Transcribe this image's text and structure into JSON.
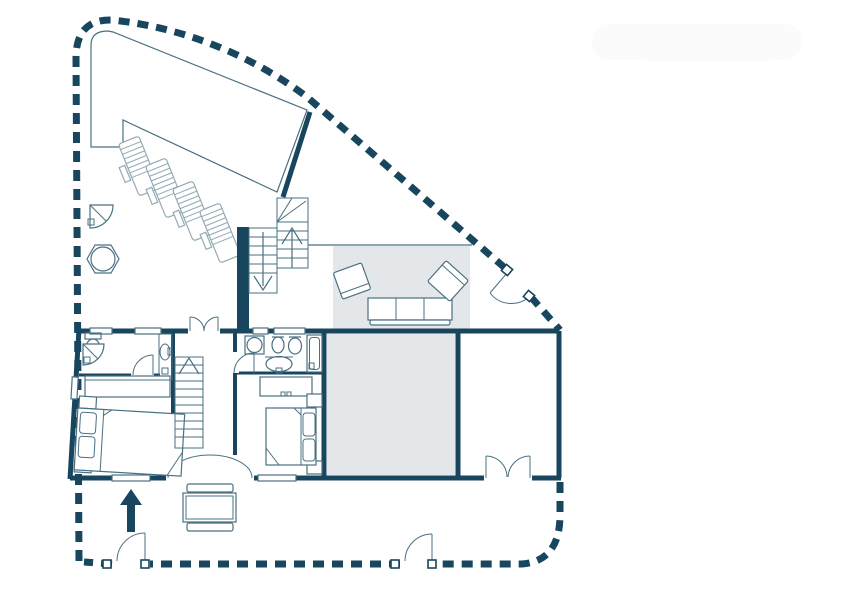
{
  "image": {
    "width": 842,
    "height": 595,
    "background": "#ffffff",
    "type": "architectural-floor-plan",
    "visible_text": []
  },
  "colors": {
    "wall": "#17465e",
    "line": "#4a7082",
    "light": "#93a9b4",
    "shade": "#e4e7e9",
    "watermark": "#fbfbfb"
  },
  "floor_plan": {
    "boundary": "thick dashed property fence with rounded corners, three gate openings with swing doors",
    "areas": [
      {
        "name": "pool-terrace",
        "desc": "large slanted polygon deck, top-left"
      },
      {
        "name": "courtyard",
        "desc": "open area with loungers, outdoor shower, spa table, stairs"
      },
      {
        "name": "living-area",
        "desc": "gray shaded rug with sofa and two armchairs"
      },
      {
        "name": "bedroom-left",
        "desc": "bed, dresser, nightstands, en-suite bath with toilet, corner shower, basin niche"
      },
      {
        "name": "hall-stairwell",
        "desc": "straight staircase up, double doors top, wide arched entry bottom"
      },
      {
        "name": "bedroom-middle",
        "desc": "bed, dresser, bath with round basin, bidet, toilet, shower, vanity sink"
      },
      {
        "name": "shaded-room",
        "desc": "gray filled room"
      },
      {
        "name": "garage",
        "desc": "empty room with double entry door"
      },
      {
        "name": "entry-porch",
        "desc": "entrance arrow, picnic table with benches"
      }
    ],
    "symbols": [
      "dashed-fence",
      "gate-door",
      "pool-wall",
      "sun-lounger",
      "outdoor-shower",
      "spa-table",
      "winder-stairs",
      "stair-up-arrow",
      "stair-down-arrow",
      "sofa",
      "armchair",
      "window",
      "double-swing-door",
      "door-arc",
      "toilet",
      "bidet",
      "shower",
      "washbasin",
      "bed",
      "pillow",
      "nightstand",
      "dresser",
      "entry-arrow",
      "picnic-table",
      "garage-door"
    ]
  }
}
